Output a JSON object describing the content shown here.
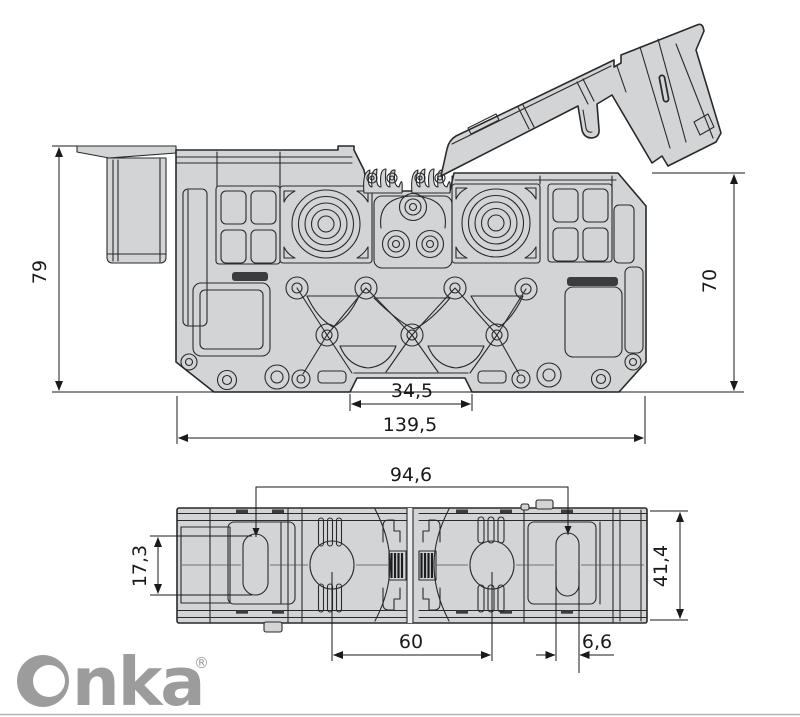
{
  "drawing_type": "technical-dimension-drawing",
  "views": [
    {
      "id": "side-view",
      "description": "side elevation with hinged cover open",
      "dimension_keys": [
        "height_left",
        "height_right",
        "notch_width",
        "overall_length"
      ]
    },
    {
      "id": "top-view",
      "description": "top view of terminal block",
      "dimension_keys": [
        "slot_span",
        "slot_length",
        "overall_width",
        "center_span",
        "slot_width"
      ]
    }
  ],
  "dims": {
    "height_left": "79",
    "height_right": "70",
    "notch_width": "34,5",
    "overall_length": "139,5",
    "slot_span": "94,6",
    "slot_length": "17,3",
    "overall_width": "41,4",
    "center_span": "60",
    "slot_width": "6,6"
  },
  "logo": {
    "text": "Onka",
    "tail": "nka",
    "reg": "®"
  },
  "colors": {
    "part_fill": "#d3d4d6",
    "outline": "#2a2a2a",
    "dimension": "#1a1a1a",
    "logo": "#9c9c9c",
    "background": "#ffffff",
    "accent_dark": "#1c1c1c"
  }
}
